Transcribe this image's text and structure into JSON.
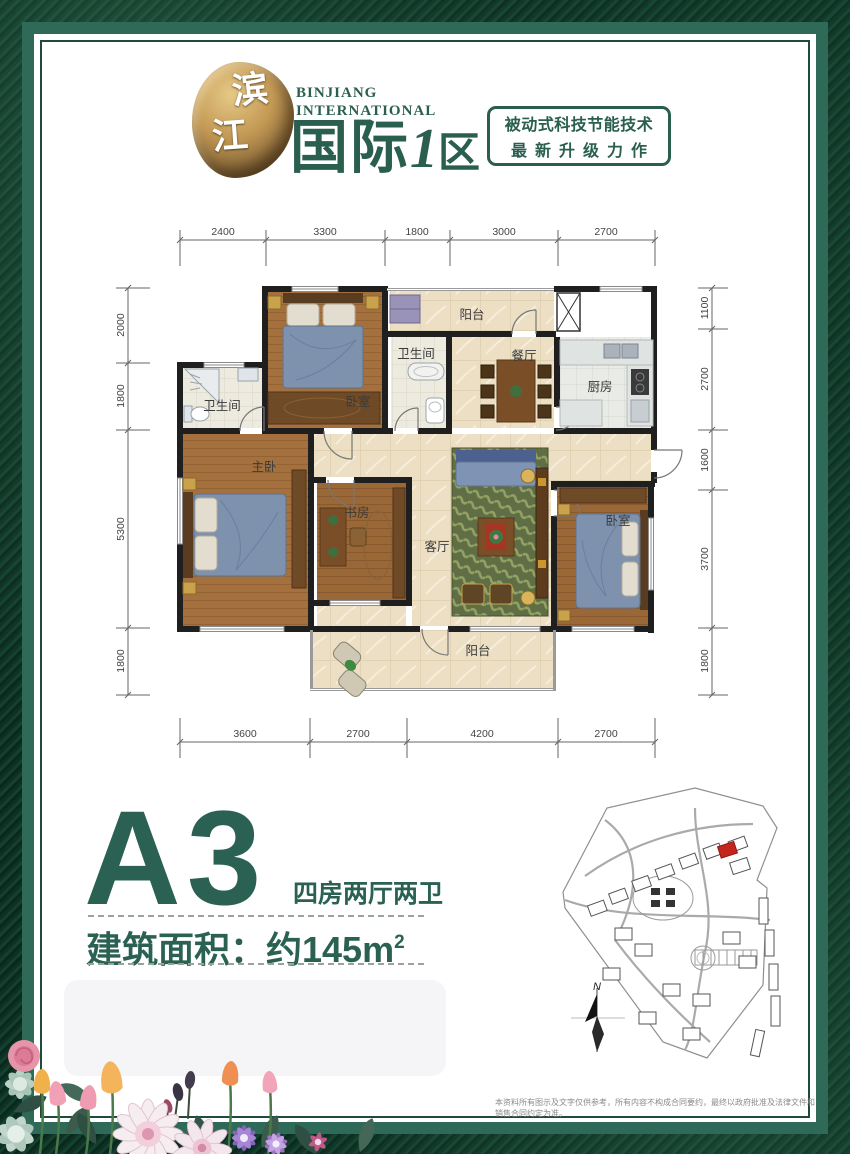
{
  "brand": {
    "stone_char1": "滨",
    "stone_char2": "江",
    "en_line1": "BINJIANG",
    "en_line2": "INTERNATIONAL",
    "cn_main": "国际",
    "cn_one": "1",
    "cn_qu": "区",
    "badge_line1": "被动式科技节能技术",
    "badge_line2": "最新升级力作"
  },
  "colors": {
    "brand_green": "#2b6152",
    "frame_dark": "#0d3225",
    "frame_band": "#2f6a59",
    "highlight_building_red": "#c4261d"
  },
  "dims": {
    "top": [
      "2400",
      "3300",
      "1800",
      "3000",
      "2700"
    ],
    "bottom": [
      "3600",
      "2700",
      "4200",
      "2700"
    ],
    "left": [
      "2000",
      "1800",
      "5300",
      "1800"
    ],
    "right": [
      "1100",
      "2700",
      "1600",
      "3700",
      "1800"
    ]
  },
  "rooms": {
    "balcony_top": "阳台",
    "bath_left": "卫生间",
    "bedroom_top": "卧室",
    "bath_mid": "卫生间",
    "dining": "餐厅",
    "kitchen": "厨房",
    "master": "主卧",
    "study": "书房",
    "living": "客厅",
    "bedroom_right": "卧室",
    "balcony_bottom": "阳台"
  },
  "unit": {
    "name": "A3",
    "layout": "四房两厅两卫",
    "area_label": "建筑面积：约145m",
    "area_sup": "2"
  },
  "siteplan": {
    "north": "N"
  },
  "disclaimer": "本资料所有图示及文字仅供参考，所有内容不构成合同要约，最终以政府批准及法律文件和销售合同约定为准。"
}
